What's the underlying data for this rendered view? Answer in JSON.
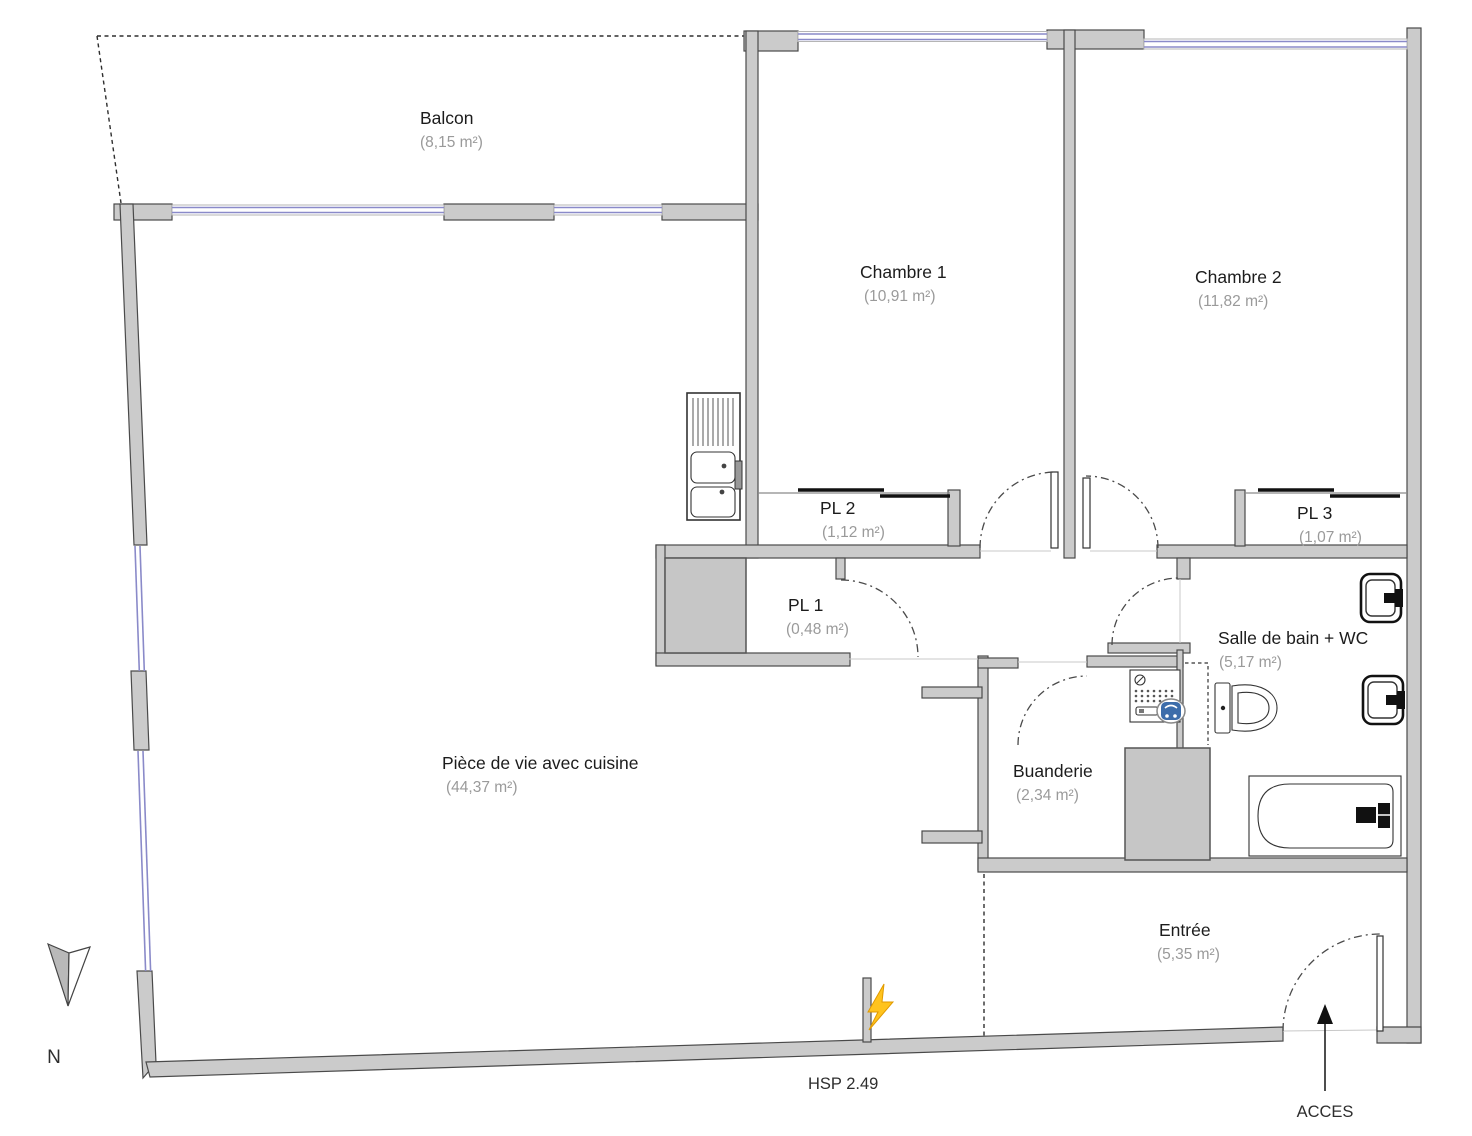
{
  "rooms": {
    "balcon": {
      "name": "Balcon",
      "area": "(8,15 m²)"
    },
    "chambre1": {
      "name": "Chambre 1",
      "area": "(10,91 m²)"
    },
    "chambre2": {
      "name": "Chambre 2",
      "area": "(11,82 m²)"
    },
    "pl1": {
      "name": "PL 1",
      "area": "(0,48 m²)"
    },
    "pl2": {
      "name": "PL 2",
      "area": "(1,12 m²)"
    },
    "pl3": {
      "name": "PL 3",
      "area": "(1,07 m²)"
    },
    "salle_de_bain": {
      "name": "Salle de bain + WC",
      "area": "(5,17 m²)"
    },
    "buanderie": {
      "name": "Buanderie",
      "area": "(2,34 m²)"
    },
    "piece_de_vie": {
      "name": "Pièce de vie avec cuisine",
      "area": "(44,37 m²)"
    },
    "entree": {
      "name": "Entrée",
      "area": "(5,35 m²)"
    }
  },
  "annotations": {
    "ceiling_height": "HSP 2.49",
    "access": "ACCES",
    "north": "N"
  },
  "icons": {
    "north_arrow": "north-arrow-icon",
    "lightning": "electric-supply-icon",
    "access_arrow": "access-arrow-icon",
    "kitchen_sink": "kitchen-sink-icon",
    "washing_machine": "washing-machine-icon",
    "toilet": "toilet-icon",
    "washbasin": "washbasin-icon",
    "bathtub": "bathtub-icon"
  },
  "colors": {
    "wall_fill": "#cbcbcb",
    "wall_stroke": "#4a4a4a",
    "shaft_fill": "#c6c6c6",
    "window": "#8a8ac9",
    "room_text": "#1c1c1c",
    "area_text": "#9a9a9a",
    "note_text": "#2e2e2e",
    "door_arc": "#4a4a4a",
    "lightning": "#ffc31e",
    "washer_drum": "#3d6daa"
  }
}
